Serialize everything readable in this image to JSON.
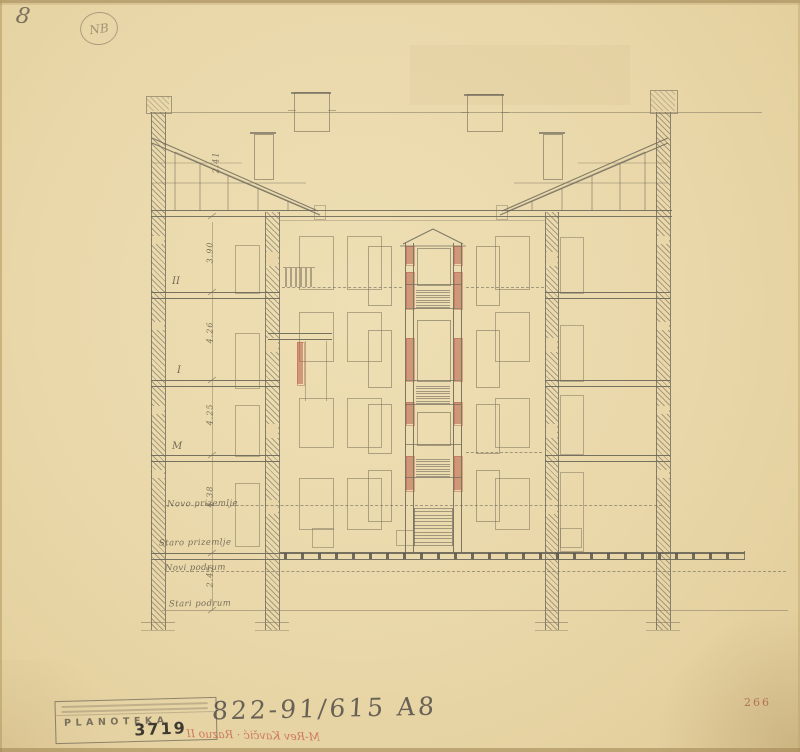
{
  "annotations": {
    "corner_number": "8",
    "circled_mark": "NB",
    "archive_number": "266",
    "pencil_code": "822-91/615 A8",
    "red_inscription": "M-Rev Kavčić · Razuo II",
    "stamp": {
      "title": "PLANOTEKA",
      "number": "3719"
    }
  },
  "drawing": {
    "floor_labels": [
      "II",
      "I",
      "M"
    ],
    "level_labels": [
      "Novo prizemlje",
      "Staro prizemlje",
      "Novi podrum",
      "Stari podrum"
    ],
    "dimensions": [
      "2.41",
      "3.90",
      "4.26",
      "4.25",
      "4.38",
      "2.45"
    ],
    "colors": {
      "paper": "#e9d7a9",
      "pencil": "#6f6a5b",
      "faint_line": "#a79a7c",
      "red_accent": "#b65f4b"
    }
  }
}
